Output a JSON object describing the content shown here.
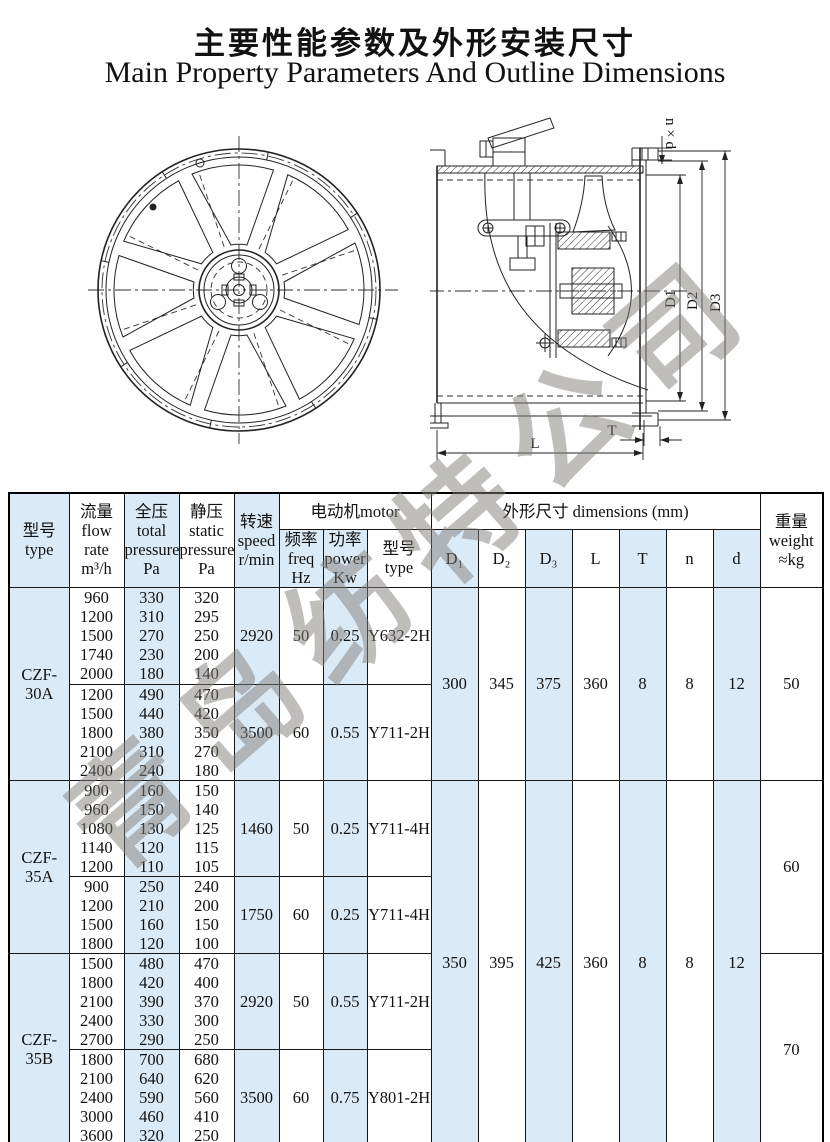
{
  "page": {
    "title_zh": "主要性能参数及外形安装尺寸",
    "title_en": "Main Property Parameters And Outline Dimensions"
  },
  "watermark": {
    "text": "青岛纺特公司"
  },
  "colors": {
    "accent_blue": "#daeaf6",
    "line": "#151515",
    "watermark_gray": "#827d78"
  },
  "side_view_labels": {
    "nxd": "n × d",
    "d1": "D1",
    "d2": "D2",
    "d3": "D3",
    "L": "L",
    "T": "T"
  },
  "table": {
    "header": {
      "type": "型号\ntype",
      "flow": "流量\nflow rate\nm³/h",
      "total": "全压\ntotal\npressure\nPa",
      "static": "静压\nstatic\npressure\nPa",
      "speed": "转速\nspeed\nr/min",
      "motor_group": "电动机motor",
      "freq": "频率\nfreq\nHz",
      "power": "功率\npower\nKw",
      "motor_type": "型号\ntype",
      "dim_group": "外形尺寸 dimensions  (mm)",
      "dims": {
        "d1": "D₁",
        "d2": "D₂",
        "d3": "D₃",
        "L": "L",
        "T": "T",
        "n": "n",
        "d": "d"
      },
      "weight": "重量\nweight\n≈kg"
    },
    "groups": [
      {
        "model": "CZF-30A",
        "weight": "50",
        "blocks": [
          {
            "flow": [
              "960",
              "1200",
              "1500",
              "1740",
              "2000"
            ],
            "total": [
              "330",
              "310",
              "270",
              "230",
              "180"
            ],
            "static": [
              "320",
              "295",
              "250",
              "200",
              "140"
            ],
            "speed": "2920",
            "freq": "50",
            "power": "0.25",
            "motor": "Y632-2H"
          },
          {
            "flow": [
              "1200",
              "1500",
              "1800",
              "2100",
              "2400"
            ],
            "total": [
              "490",
              "440",
              "380",
              "310",
              "240"
            ],
            "static": [
              "470",
              "420",
              "350",
              "270",
              "180"
            ],
            "speed": "3500",
            "freq": "60",
            "power": "0.55",
            "motor": "Y711-2H"
          }
        ]
      },
      {
        "model": "CZF-35A",
        "weight": "60",
        "blocks": [
          {
            "flow": [
              "900",
              "960",
              "1080",
              "1140",
              "1200"
            ],
            "total": [
              "160",
              "150",
              "130",
              "120",
              "110"
            ],
            "static": [
              "150",
              "140",
              "125",
              "115",
              "105"
            ],
            "speed": "1460",
            "freq": "50",
            "power": "0.25",
            "motor": "Y711-4H"
          },
          {
            "flow": [
              "900",
              "1200",
              "1500",
              "1800"
            ],
            "total": [
              "250",
              "210",
              "160",
              "120"
            ],
            "static": [
              "240",
              "200",
              "150",
              "100"
            ],
            "speed": "1750",
            "freq": "60",
            "power": "0.25",
            "motor": "Y711-4H"
          }
        ]
      },
      {
        "model": "CZF-35B",
        "weight": "70",
        "blocks": [
          {
            "flow": [
              "1500",
              "1800",
              "2100",
              "2400",
              "2700"
            ],
            "total": [
              "480",
              "420",
              "390",
              "330",
              "290"
            ],
            "static": [
              "470",
              "400",
              "370",
              "300",
              "250"
            ],
            "speed": "2920",
            "freq": "50",
            "power": "0.55",
            "motor": "Y711-2H"
          },
          {
            "flow": [
              "1800",
              "2100",
              "2400",
              "3000",
              "3600"
            ],
            "total": [
              "700",
              "640",
              "590",
              "460",
              "320"
            ],
            "static": [
              "680",
              "620",
              "560",
              "410",
              "250"
            ],
            "speed": "3500",
            "freq": "60",
            "power": "0.75",
            "motor": "Y801-2H"
          }
        ]
      }
    ],
    "dimensions": [
      {
        "models": "CZF-30A",
        "d1": "300",
        "d2": "345",
        "d3": "375",
        "L": "360",
        "T": "8",
        "n": "8",
        "d": "12"
      },
      {
        "models": "CZF-35A / CZF-35B",
        "d1": "350",
        "d2": "395",
        "d3": "425",
        "L": "360",
        "T": "8",
        "n": "8",
        "d": "12"
      }
    ]
  }
}
